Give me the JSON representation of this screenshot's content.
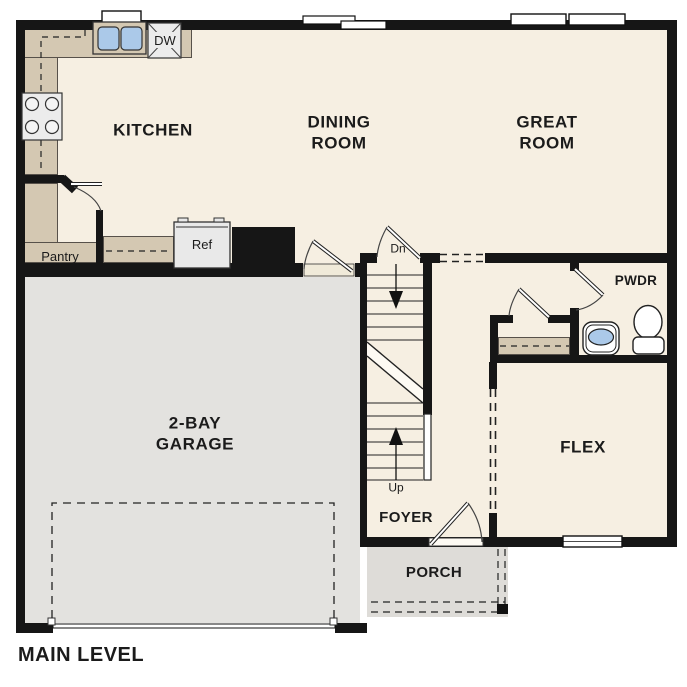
{
  "title": "MAIN LEVEL",
  "colors": {
    "floor": "#f6efe2",
    "garage_floor": "#e3e2df",
    "porch_floor": "#dedcd8",
    "counter": "#d4c8b2",
    "wall": "#161616",
    "fixture_fill": "#ececec",
    "sink_blue": "#abc9e9"
  },
  "rooms": {
    "kitchen": {
      "label": "KITCHEN"
    },
    "dining": {
      "line1": "DINING",
      "line2": "ROOM"
    },
    "great": {
      "line1": "GREAT",
      "line2": "ROOM"
    },
    "garage": {
      "line1": "2-BAY",
      "line2": "GARAGE"
    },
    "flex": {
      "label": "FLEX"
    },
    "foyer": {
      "label": "FOYER"
    },
    "porch": {
      "label": "PORCH"
    },
    "pwdr": {
      "label": "PWDR"
    },
    "pantry": {
      "label": "Pantry"
    }
  },
  "fixtures": {
    "refrigerator": "Ref",
    "dishwasher": "DW"
  },
  "stairs": {
    "down": "Dn",
    "up": "Up"
  }
}
